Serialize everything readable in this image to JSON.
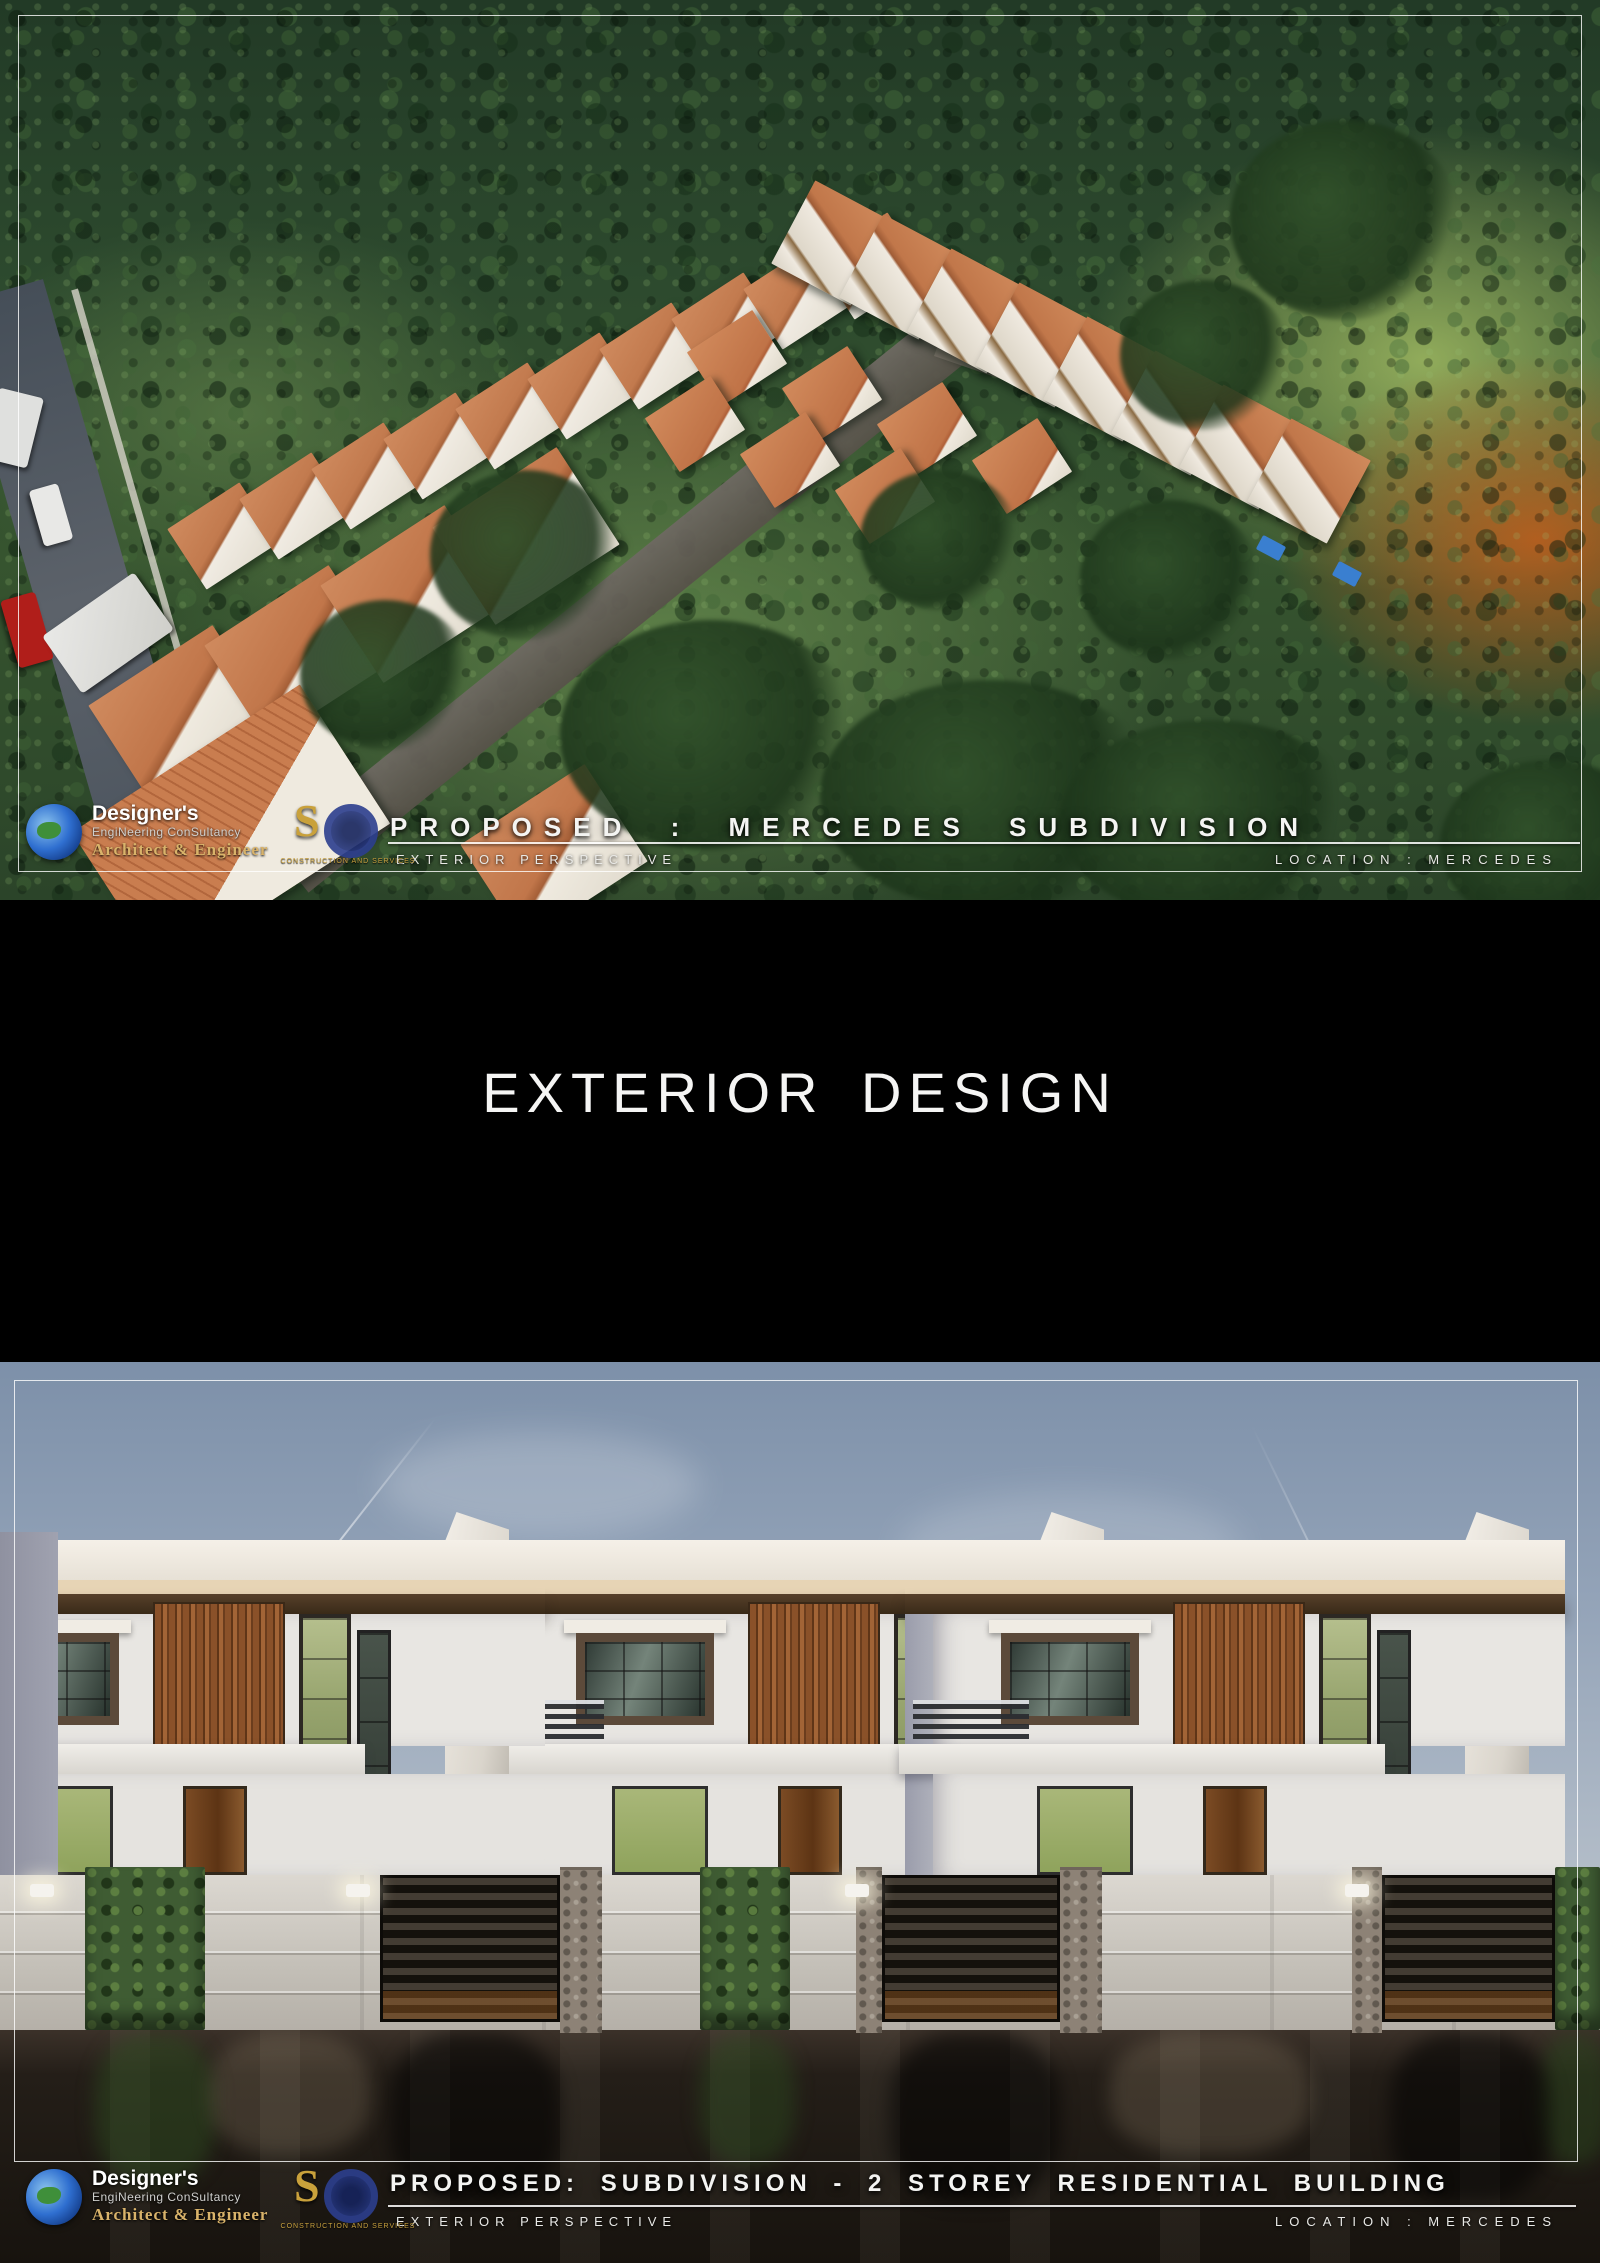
{
  "palette": {
    "terracotta_roof": "#c1774a",
    "forest_green": "#2e4a2e",
    "sky_blue": "#93a3b8",
    "accent_gold": "#c9a23f",
    "wood_slat": "#8a5129",
    "glass_green": "#a9b779",
    "wall_white": "#e9e6e1",
    "pavement_dark": "#1b1510",
    "frame_line": "#ffffff"
  },
  "top_panel": {
    "title": "PROPOSED :  MERCEDES SUBDIVISION",
    "subtitle": "EXTERIOR PERSPECTIVE",
    "location": "LOCATION : MERCEDES"
  },
  "divider": {
    "title": "EXTERIOR DESIGN"
  },
  "bottom_panel": {
    "title": "PROPOSED: SUBDIVISION - 2 STOREY RESIDENTIAL BUILDING",
    "subtitle": "EXTERIOR PERSPECTIVE",
    "location": "LOCATION : MERCEDES"
  },
  "branding": {
    "firm_name": "Designer's",
    "firm_line2": "EngiNeering ConSultancy",
    "firm_line3": "Architect & Engineer",
    "partner_initial_s": "S",
    "partner_initial_g": "G",
    "partner_tagline": "CONSTRUCTION AND SERVICES"
  }
}
